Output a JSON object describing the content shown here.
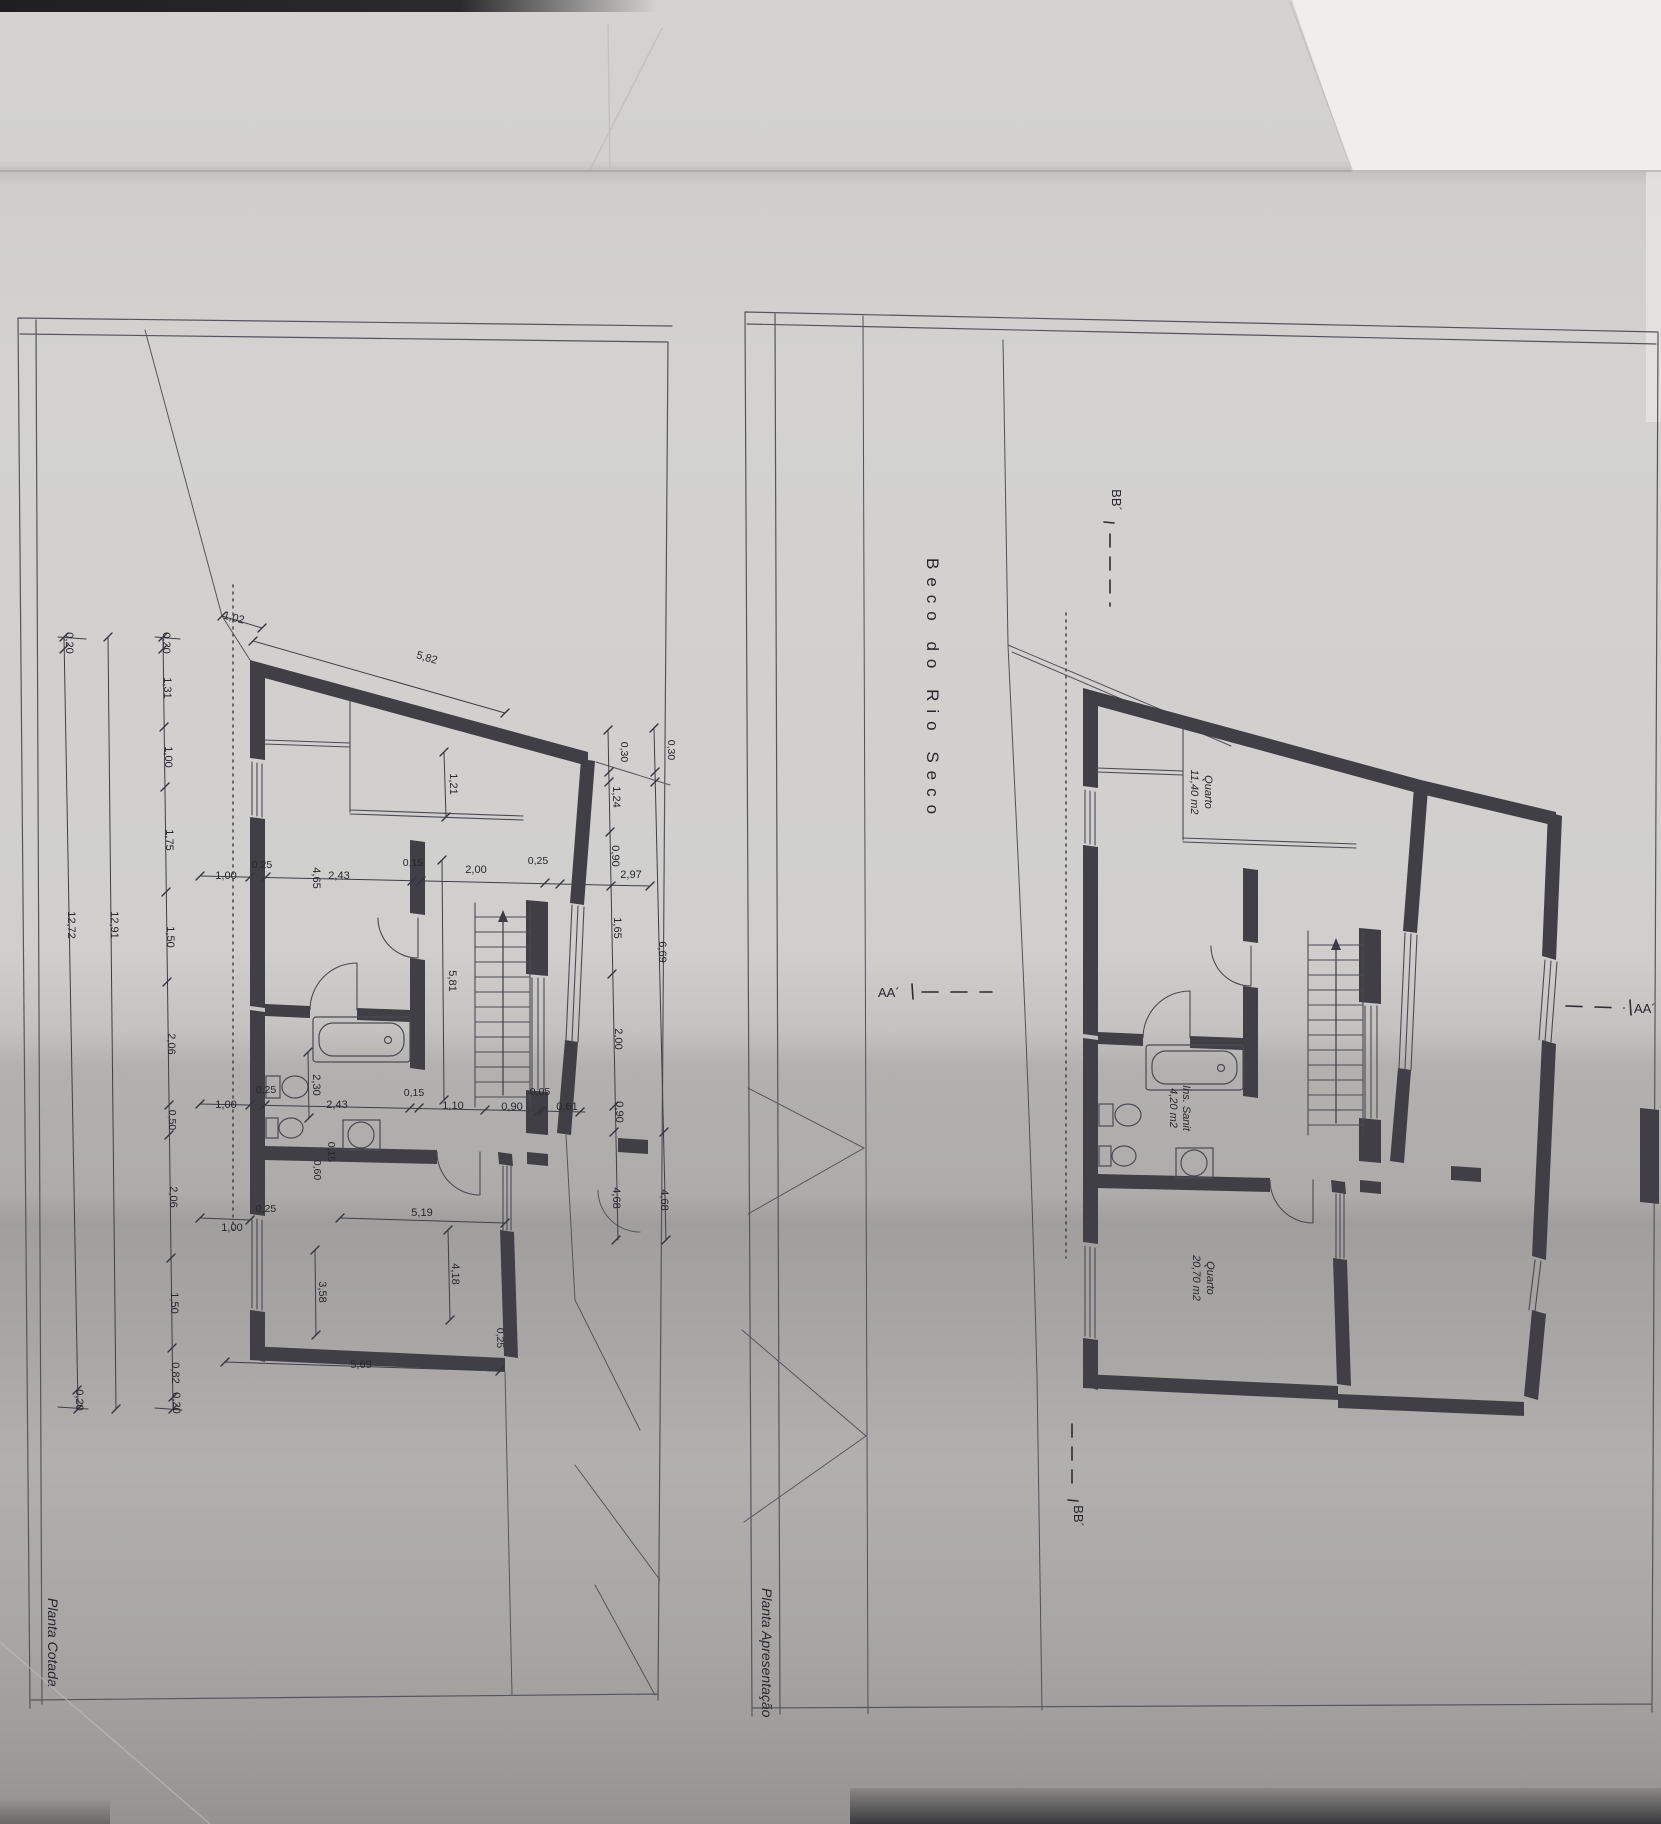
{
  "titles": {
    "left_sheet": "Planta Cotada",
    "right_sheet": "Planta Apresentação"
  },
  "street_label": "Beco do Rio Seco",
  "sections": {
    "aa": "AA´",
    "bb": "BB´"
  },
  "rooms": {
    "bedroom_upper": {
      "name": "Quarto",
      "area": "11,40 m2"
    },
    "bathroom": {
      "name": "Ins. Sanit",
      "area": "4,20 m2"
    },
    "bedroom_lower": {
      "name": "Quarto",
      "area": "20,70 m2"
    }
  },
  "dims": {
    "v0_05": "0,05",
    "v0_15": "0,15",
    "v0_20": "0,20",
    "v0_25": "0,25",
    "v0_30": "0,30",
    "v0_50": "0,50",
    "v0_60": "0,60",
    "v0_61": "0,61",
    "v0_82": "0,82",
    "v0_90": "0,90",
    "v1_00": "1,00",
    "v1_02": "1,02",
    "v1_10": "1,10",
    "v1_21": "1,21",
    "v1_24": "1,24",
    "v1_31": "1,31",
    "v1_50": "1,50",
    "v1_65": "1,65",
    "v1_75": "1,75",
    "v2_00": "2,00",
    "v2_06": "2,06",
    "v2_30": "2,30",
    "v2_43": "2,43",
    "v2_97": "2,97",
    "v3_58": "3,58",
    "v4_18": "4,18",
    "v4_65": "4,65",
    "v4_68": "4,68",
    "v5_19": "5,19",
    "v5_69": "5,69",
    "v5_81": "5,81",
    "v5_82": "5,82",
    "v6_69": "6,69",
    "v12_72": "12,72",
    "v12_91": "12,91"
  },
  "colors": {
    "paper": "#d3d2d0",
    "paper_shadow": "#a09f9d",
    "line": "#4a4a52",
    "wall": "#3f3f45",
    "text": "#26262c",
    "edge_white": "#efeeec",
    "edge_dark": "#232325"
  }
}
